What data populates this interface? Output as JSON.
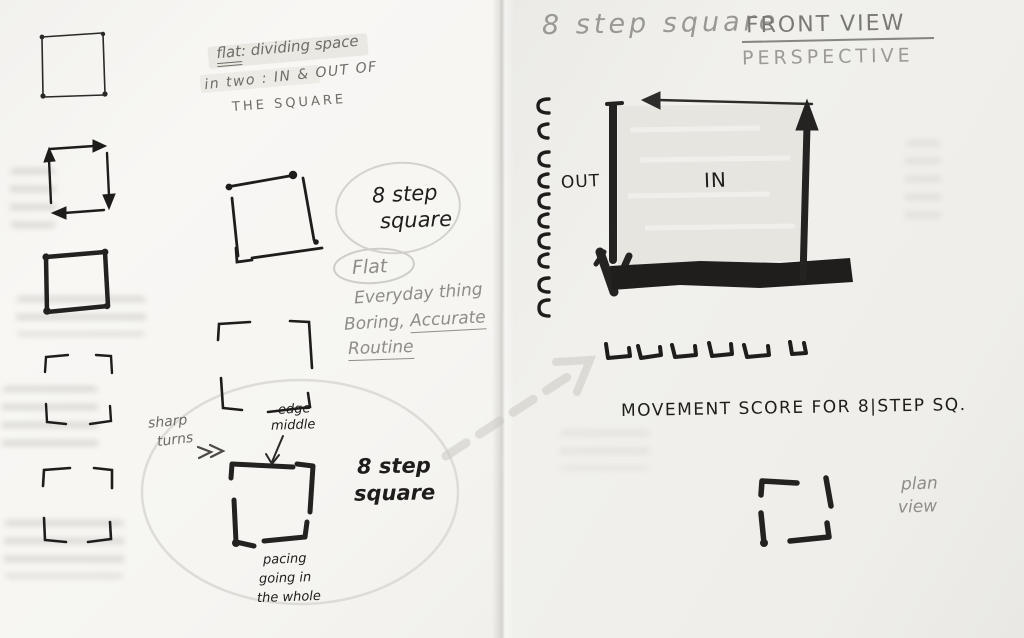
{
  "colors": {
    "ink": "#1e1d1b",
    "marker_black": "#232220",
    "pencil": "#8f8d87",
    "pencil_dark": "#6e6c66",
    "paper_left": "#f6f5f2",
    "paper_right": "#efeeea",
    "marker_shade_fill": "#e5e3de",
    "highlighter": "#eceae4"
  },
  "left_page": {
    "definition_note": {
      "term": "flat",
      "after_term": ": dividing space",
      "line2": "in two : IN & OUT OF",
      "line3": "THE SQUARE"
    },
    "step_square_label": {
      "line1": "8 step",
      "line2": "square"
    },
    "qualities": {
      "circled": "Flat",
      "everyday": "Everyday thing",
      "boring_prefix": "Boring,",
      "accurate": "Accurate",
      "routine": "Routine"
    },
    "sharp_turn_note": {
      "line1": "sharp",
      "line2": "turns"
    },
    "edge_middle_note": {
      "line1": "edge",
      "line2": "middle"
    },
    "bold_step_square_label": {
      "line1": "8 step",
      "line2": "square"
    },
    "pacing_note": {
      "line1": "pacing",
      "line2": "going in",
      "line3": "the whole"
    }
  },
  "right_page": {
    "title": "8 step square",
    "view_label": "FRONT VIEW",
    "perspective_label": "PERSPECTIVE",
    "out_label": "OUT",
    "in_label": "IN",
    "score_caption": "MOVEMENT SCORE FOR 8|STEP SQ.",
    "plan_view_note": {
      "line1": "plan",
      "line2": "view"
    }
  }
}
